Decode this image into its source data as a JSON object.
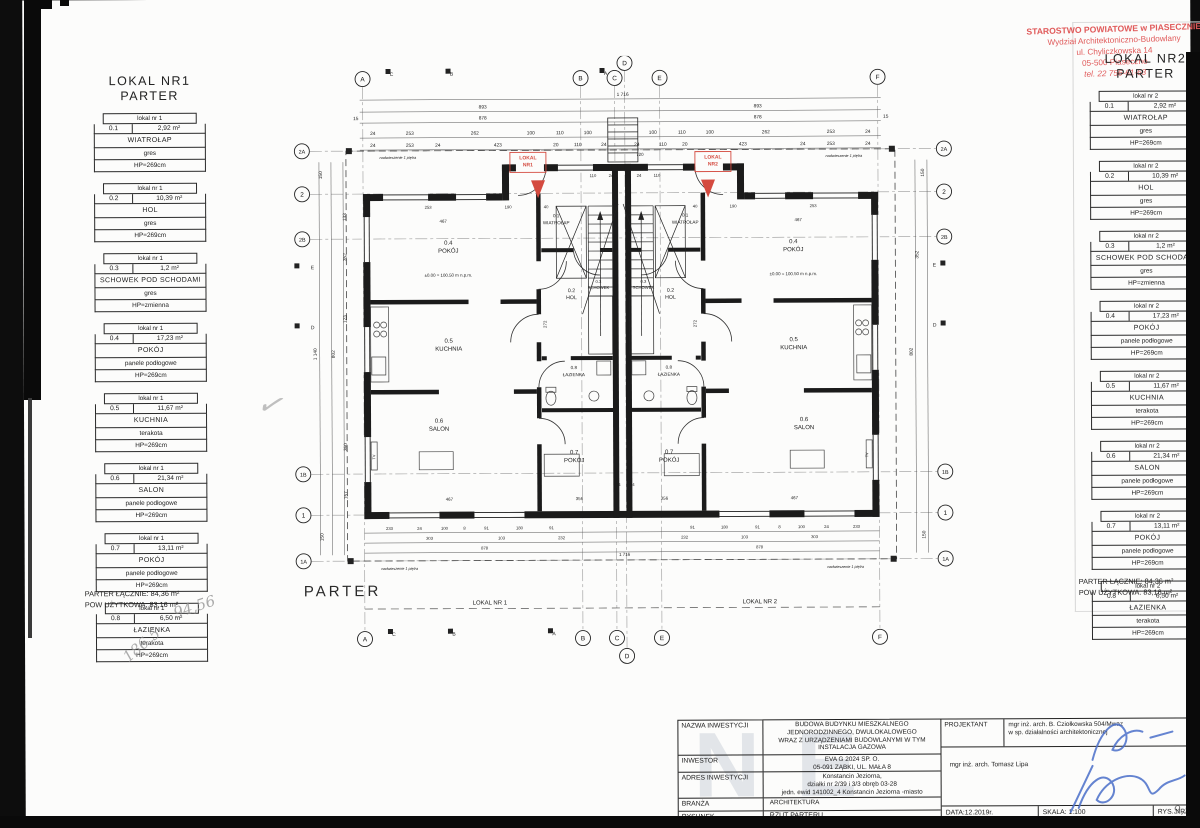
{
  "page": {
    "parter_label": "PARTER"
  },
  "stamp": {
    "line1": "STAROSTWO POWIATOWE w PIASECZNIE",
    "line2": "Wydział Architektoniczno-Budowlany",
    "line3": "ul. Chyliczkowska 14",
    "line4": "05-500 Piaseczno",
    "line5": "tel. 22 756-61-63"
  },
  "legend_left": {
    "title_line1": "LOKAL NR1",
    "title_line2": "PARTER",
    "rooms": [
      {
        "header": "lokal nr 1",
        "id": "0.1",
        "area": "2,92 m²",
        "name": "WIATROŁAP",
        "floor": "gres",
        "height": "HP=269cm"
      },
      {
        "header": "lokal nr 1",
        "id": "0.2",
        "area": "10,39 m²",
        "name": "HOL",
        "floor": "gres",
        "height": "HP=269cm"
      },
      {
        "header": "lokal nr 1",
        "id": "0.3",
        "area": "1,2 m²",
        "name": "SCHOWEK POD SCHODAMI",
        "floor": "gres",
        "height": "HP=zmienna"
      },
      {
        "header": "lokal nr 1",
        "id": "0.4",
        "area": "17,23 m²",
        "name": "POKÓJ",
        "floor": "panele podłogowe",
        "height": "HP=269cm"
      },
      {
        "header": "lokal nr 1",
        "id": "0.5",
        "area": "11,67 m²",
        "name": "KUCHNIA",
        "floor": "terakota",
        "height": "HP=269cm"
      },
      {
        "header": "lokal nr 1",
        "id": "0.6",
        "area": "21,34 m²",
        "name": "SALON",
        "floor": "panele podłogowe",
        "height": "HP=269cm"
      },
      {
        "header": "lokal nr 1",
        "id": "0.7",
        "area": "13,11 m²",
        "name": "POKÓJ",
        "floor": "panele podłogowe",
        "height": "HP=269cm"
      },
      {
        "header": "lokal nr 1",
        "id": "0.8",
        "area": "6,50 m²",
        "name": "ŁAZIENKA",
        "floor": "terakota",
        "height": "HP=269cm"
      }
    ],
    "total1": "PARTER ŁĄCZNIE: 84,36 m²",
    "total2": "POW UŻYTKOWA: 83,16 m²"
  },
  "legend_right": {
    "title_line1": "LOKAL NR2",
    "title_line2": "PARTER",
    "rooms": [
      {
        "header": "lokal nr 2",
        "id": "0.1",
        "area": "2,92 m²",
        "name": "WIATROŁAP",
        "floor": "gres",
        "height": "HP=269cm"
      },
      {
        "header": "lokal nr 2",
        "id": "0.2",
        "area": "10,39 m²",
        "name": "HOL",
        "floor": "gres",
        "height": "HP=269cm"
      },
      {
        "header": "lokal nr 2",
        "id": "0.3",
        "area": "1,2 m²",
        "name": "SCHOWEK POD SCHODAMI",
        "floor": "gres",
        "height": "HP=zmienna"
      },
      {
        "header": "lokal nr 2",
        "id": "0.4",
        "area": "17,23 m²",
        "name": "POKÓJ",
        "floor": "panele podłogowe",
        "height": "HP=269cm"
      },
      {
        "header": "lokal nr 2",
        "id": "0.5",
        "area": "11,67 m²",
        "name": "KUCHNIA",
        "floor": "terakota",
        "height": "HP=269cm"
      },
      {
        "header": "lokal nr 2",
        "id": "0.6",
        "area": "21,34 m²",
        "name": "SALON",
        "floor": "panele podłogowe",
        "height": "HP=269cm"
      },
      {
        "header": "lokal nr 2",
        "id": "0.7",
        "area": "13,11 m²",
        "name": "POKÓJ",
        "floor": "panele podłogowe",
        "height": "HP=269cm"
      },
      {
        "header": "lokal nr 2",
        "id": "0.8",
        "area": "6,50 m²",
        "name": "ŁAZIENKA",
        "floor": "terakota",
        "height": "HP=269cm"
      }
    ],
    "total1": "PARTER ŁĄCZNIE: 84,36 m²",
    "total2": "POW UŻYTKOWA: 83,16 m²"
  },
  "titleblock": {
    "nazwa_label": "NAZWA INWESTYCJI",
    "nazwa": "BUDOWA BUDYNKU MIESZKALNEGO\nJEDNORODZINNEGO, DWULOKALOWEGO\nWRAZ Z URZĄDZENIAMI BUDOWLANYMI W TYM\nINSTALACJA GAZOWA",
    "inwestor_label": "INWESTOR",
    "inwestor": "EVA G 2024 SP. O.\n05-091 ZĄBKI, UL. MAŁA 8",
    "adres_label": "ADRES INWESTYCJI",
    "adres": "Konstancin Jeziorna,\ndziałki nr 2/39 i 3/3 obręb 03-28\njedn. ewid 141002_4 Konstancin Jeziorna -miasto",
    "branza_label": "BRANŻA",
    "branza": "ARCHITEKTURA",
    "rysunek_label": "RYSUNEK",
    "rysunek": "RZUT PARTERU",
    "projektant_label": "PROJEKTANT",
    "projektant": "mgr inż. arch. B. Cziołkowska 504/Mwaz\nw sp. działalności architektonicznej",
    "projektant2": "mgr inż. arch. Tomasz Lipa",
    "data": "DATA:12.2019r.",
    "skala": "SKALA: 1:100",
    "rys_nr": "RYS. NR. A1",
    "signature_color": "#4a6fc9"
  },
  "annotations": {
    "watermark": "NE",
    "pencil1": "94,56",
    "pencil2": "186,5",
    "pencil3": "✓",
    "pencil4": "9,5"
  },
  "plan": {
    "accent_red": "#d44a3f",
    "bubbles": [
      {
        "x": 75,
        "y": 22,
        "t": "A"
      },
      {
        "x": 293,
        "y": 22,
        "t": "B"
      },
      {
        "x": 327,
        "y": 22,
        "t": "C"
      },
      {
        "x": 337,
        "y": 7,
        "t": "D"
      },
      {
        "x": 372,
        "y": 22,
        "t": "E"
      },
      {
        "x": 590,
        "y": 22,
        "t": "F"
      },
      {
        "x": 75,
        "y": 582,
        "t": "A"
      },
      {
        "x": 293,
        "y": 582,
        "t": "B"
      },
      {
        "x": 327,
        "y": 582,
        "t": "C"
      },
      {
        "x": 337,
        "y": 600,
        "t": "D"
      },
      {
        "x": 372,
        "y": 582,
        "t": "E"
      },
      {
        "x": 590,
        "y": 582,
        "t": "F"
      },
      {
        "x": 14,
        "y": 94,
        "t": "2A"
      },
      {
        "x": 14,
        "y": 137,
        "t": "2"
      },
      {
        "x": 14,
        "y": 182,
        "t": "2B"
      },
      {
        "x": 14,
        "y": 417,
        "t": "1B"
      },
      {
        "x": 14,
        "y": 458,
        "t": "1"
      },
      {
        "x": 14,
        "y": 504,
        "t": "1A"
      },
      {
        "x": 656,
        "y": 94,
        "t": "2A"
      },
      {
        "x": 656,
        "y": 137,
        "t": "2"
      },
      {
        "x": 656,
        "y": 182,
        "t": "2B"
      },
      {
        "x": 656,
        "y": 417,
        "t": "1B"
      },
      {
        "x": 656,
        "y": 458,
        "t": "1"
      },
      {
        "x": 656,
        "y": 504,
        "t": "1A"
      }
    ],
    "flags": [
      {
        "x": 98,
        "y": 12
      },
      {
        "x": 158,
        "y": 12
      },
      {
        "x": 312,
        "y": 12
      },
      {
        "x": 98,
        "y": 572
      },
      {
        "x": 158,
        "y": 572
      },
      {
        "x": 258,
        "y": 572
      },
      {
        "x": 6,
        "y": 206
      },
      {
        "x": 6,
        "y": 266
      },
      {
        "x": 652,
        "y": 206
      },
      {
        "x": 652,
        "y": 266
      }
    ],
    "texts": [
      {
        "x": 160,
        "y": 188,
        "t": "0.4",
        "s": 6
      },
      {
        "x": 160,
        "y": 196,
        "t": "POKÓJ",
        "s": 6
      },
      {
        "x": 160,
        "y": 286,
        "t": "0.5",
        "s": 6
      },
      {
        "x": 160,
        "y": 294,
        "t": "KUCHNIA",
        "s": 6
      },
      {
        "x": 150,
        "y": 366,
        "t": "0.6",
        "s": 6
      },
      {
        "x": 150,
        "y": 374,
        "t": "SALON",
        "s": 6
      },
      {
        "x": 268,
        "y": 161,
        "t": "0.1",
        "s": 4.6
      },
      {
        "x": 268,
        "y": 168,
        "t": "WIATROŁAP",
        "s": 4.6
      },
      {
        "x": 283,
        "y": 236,
        "t": "0.2",
        "s": 5.2
      },
      {
        "x": 283,
        "y": 243,
        "t": "HOL",
        "s": 5.2
      },
      {
        "x": 285,
        "y": 313,
        "t": "0.8",
        "s": 4.6
      },
      {
        "x": 285,
        "y": 320,
        "t": "ŁAZIENKA",
        "s": 4.6
      },
      {
        "x": 285,
        "y": 398,
        "t": "0.7",
        "s": 6
      },
      {
        "x": 285,
        "y": 406,
        "t": "POKÓJ",
        "s": 6
      },
      {
        "x": 310,
        "y": 227,
        "t": "0.3",
        "s": 4.2
      },
      {
        "x": 310,
        "y": 233,
        "t": "SCHOWEK",
        "s": 4.2
      },
      {
        "x": 505,
        "y": 188,
        "t": "0.4",
        "s": 6
      },
      {
        "x": 505,
        "y": 196,
        "t": "POKÓJ",
        "s": 6
      },
      {
        "x": 505,
        "y": 286,
        "t": "0.5",
        "s": 6
      },
      {
        "x": 505,
        "y": 294,
        "t": "KUCHNIA",
        "s": 6
      },
      {
        "x": 515,
        "y": 366,
        "t": "0.6",
        "s": 6
      },
      {
        "x": 515,
        "y": 374,
        "t": "SALON",
        "s": 6
      },
      {
        "x": 397,
        "y": 161,
        "t": "0.1",
        "s": 4.6
      },
      {
        "x": 397,
        "y": 168,
        "t": "WIATROŁAP",
        "s": 4.6
      },
      {
        "x": 382,
        "y": 236,
        "t": "0.2",
        "s": 5.2
      },
      {
        "x": 382,
        "y": 243,
        "t": "HOL",
        "s": 5.2
      },
      {
        "x": 380,
        "y": 313,
        "t": "0.8",
        "s": 4.6
      },
      {
        "x": 380,
        "y": 320,
        "t": "ŁAZIENKA",
        "s": 4.6
      },
      {
        "x": 380,
        "y": 398,
        "t": "0.7",
        "s": 6
      },
      {
        "x": 380,
        "y": 406,
        "t": "POKÓJ",
        "s": 6
      },
      {
        "x": 355,
        "y": 227,
        "t": "0.3",
        "s": 4.2
      },
      {
        "x": 355,
        "y": 233,
        "t": "SCHOWEK",
        "s": 4.2
      },
      {
        "x": 160,
        "y": 220,
        "t": "±0.00 = 100.50 m n.p.m.",
        "s": 4.4
      },
      {
        "x": 505,
        "y": 220,
        "t": "±0.00 = 100.50 m n.p.m.",
        "s": 4.4
      },
      {
        "x": 240,
        "y": 103,
        "t": "LOKAL",
        "s": 5,
        "c": "#d44a3f",
        "w": 700
      },
      {
        "x": 240,
        "y": 110,
        "t": "NR1",
        "s": 5,
        "c": "#d44a3f",
        "w": 700
      },
      {
        "x": 425,
        "y": 103,
        "t": "LOKAL",
        "s": 5,
        "c": "#d44a3f",
        "w": 700
      },
      {
        "x": 425,
        "y": 110,
        "t": "NR2",
        "s": 5,
        "c": "#d44a3f",
        "w": 700
      },
      {
        "x": 335,
        "y": 40,
        "t": "1 716"
      },
      {
        "x": 195,
        "y": 52,
        "t": "893"
      },
      {
        "x": 470,
        "y": 52,
        "t": "893"
      },
      {
        "x": 68,
        "y": 63,
        "t": "15"
      },
      {
        "x": 195,
        "y": 63,
        "t": "878"
      },
      {
        "x": 470,
        "y": 63,
        "t": "878"
      },
      {
        "x": 598,
        "y": 63,
        "t": "15"
      },
      {
        "x": 85,
        "y": 78,
        "t": "24"
      },
      {
        "x": 122,
        "y": 78,
        "t": "253"
      },
      {
        "x": 187,
        "y": 78,
        "t": "262"
      },
      {
        "x": 243,
        "y": 78,
        "t": "100"
      },
      {
        "x": 272,
        "y": 78,
        "t": "110"
      },
      {
        "x": 300,
        "y": 78,
        "t": "100"
      },
      {
        "x": 365,
        "y": 78,
        "t": "100"
      },
      {
        "x": 394,
        "y": 78,
        "t": "110"
      },
      {
        "x": 422,
        "y": 78,
        "t": "100"
      },
      {
        "x": 478,
        "y": 78,
        "t": "262"
      },
      {
        "x": 543,
        "y": 78,
        "t": "253"
      },
      {
        "x": 580,
        "y": 78,
        "t": "24"
      },
      {
        "x": 85,
        "y": 90,
        "t": "24"
      },
      {
        "x": 122,
        "y": 90,
        "t": "253"
      },
      {
        "x": 150,
        "y": 90,
        "t": "24"
      },
      {
        "x": 210,
        "y": 90,
        "t": "423"
      },
      {
        "x": 268,
        "y": 90,
        "t": "20"
      },
      {
        "x": 290,
        "y": 90,
        "t": "110"
      },
      {
        "x": 316,
        "y": 90,
        "t": "24"
      },
      {
        "x": 349,
        "y": 90,
        "t": "24"
      },
      {
        "x": 375,
        "y": 90,
        "t": "110"
      },
      {
        "x": 397,
        "y": 90,
        "t": "20"
      },
      {
        "x": 455,
        "y": 90,
        "t": "423"
      },
      {
        "x": 515,
        "y": 90,
        "t": "24"
      },
      {
        "x": 543,
        "y": 90,
        "t": "253"
      },
      {
        "x": 580,
        "y": 90,
        "t": "24"
      },
      {
        "x": 352,
        "y": 100,
        "t": "720",
        "s": 4.4
      },
      {
        "x": 110,
        "y": 102,
        "t": "nadwieszenie 1 piętra",
        "s": 3.8,
        "i": 1
      },
      {
        "x": 556,
        "y": 102,
        "t": "nadwieszenie 1 piętra",
        "s": 3.8,
        "i": 1
      },
      {
        "x": 110,
        "y": 513,
        "t": "nadwieszenie 1 piętra",
        "s": 3.8,
        "i": 1
      },
      {
        "x": 556,
        "y": 513,
        "t": "nadwieszenie 1 piętra",
        "s": 3.8,
        "i": 1
      },
      {
        "x": 305,
        "y": 121,
        "t": "110",
        "s": 4.2
      },
      {
        "x": 323,
        "y": 121,
        "t": "24",
        "s": 4.2
      },
      {
        "x": 351,
        "y": 121,
        "t": "24",
        "s": 4.2
      },
      {
        "x": 369,
        "y": 121,
        "t": "110",
        "s": 4.2
      },
      {
        "x": 140,
        "y": 152,
        "t": "253",
        "s": 4.2
      },
      {
        "x": 220,
        "y": 152,
        "t": "190",
        "s": 4.2
      },
      {
        "x": 258,
        "y": 152,
        "t": "40",
        "s": 4.2
      },
      {
        "x": 407,
        "y": 152,
        "t": "40",
        "s": 4.2
      },
      {
        "x": 445,
        "y": 152,
        "t": "190",
        "s": 4.2
      },
      {
        "x": 525,
        "y": 152,
        "t": "253",
        "s": 4.2
      },
      {
        "x": 155,
        "y": 166,
        "t": "467",
        "s": 4.4
      },
      {
        "x": 510,
        "y": 166,
        "t": "467",
        "s": 4.4
      },
      {
        "x": 258,
        "y": 268,
        "t": "272",
        "s": 4.4,
        "r": -90
      },
      {
        "x": 408,
        "y": 268,
        "t": "272",
        "s": 4.4,
        "r": -90
      },
      {
        "x": 160,
        "y": 444,
        "t": "467",
        "s": 4.4
      },
      {
        "x": 290,
        "y": 444,
        "t": "356",
        "s": 4.4
      },
      {
        "x": 375,
        "y": 444,
        "t": "356",
        "s": 4.4
      },
      {
        "x": 505,
        "y": 444,
        "t": "467",
        "s": 4.4
      },
      {
        "x": 329,
        "y": 430,
        "t": "24",
        "s": 4
      },
      {
        "x": 343,
        "y": 430,
        "t": "24",
        "s": 4
      },
      {
        "x": 100,
        "y": 473,
        "t": "233",
        "s": 4.2
      },
      {
        "x": 130,
        "y": 473,
        "t": "24",
        "s": 4.2
      },
      {
        "x": 155,
        "y": 473,
        "t": "100",
        "s": 4.2
      },
      {
        "x": 175,
        "y": 473,
        "t": "8",
        "s": 4.2
      },
      {
        "x": 197,
        "y": 473,
        "t": "91",
        "s": 4.2
      },
      {
        "x": 230,
        "y": 473,
        "t": "180",
        "s": 4.2
      },
      {
        "x": 262,
        "y": 473,
        "t": "91",
        "s": 4.2
      },
      {
        "x": 403,
        "y": 473,
        "t": "91",
        "s": 4.2
      },
      {
        "x": 435,
        "y": 473,
        "t": "180",
        "s": 4.2
      },
      {
        "x": 468,
        "y": 473,
        "t": "91",
        "s": 4.2
      },
      {
        "x": 490,
        "y": 473,
        "t": "8",
        "s": 4.2
      },
      {
        "x": 512,
        "y": 473,
        "t": "100",
        "s": 4.2
      },
      {
        "x": 537,
        "y": 473,
        "t": "24",
        "s": 4.2
      },
      {
        "x": 567,
        "y": 473,
        "t": "233",
        "s": 4.2
      },
      {
        "x": 140,
        "y": 483,
        "t": "303",
        "s": 4.2
      },
      {
        "x": 212,
        "y": 483,
        "t": "103",
        "s": 4.2
      },
      {
        "x": 272,
        "y": 483,
        "t": "232",
        "s": 4.2
      },
      {
        "x": 395,
        "y": 483,
        "t": "232",
        "s": 4.2
      },
      {
        "x": 455,
        "y": 483,
        "t": "103",
        "s": 4.2
      },
      {
        "x": 525,
        "y": 483,
        "t": "303",
        "s": 4.2
      },
      {
        "x": 195,
        "y": 493,
        "t": "878",
        "s": 4.2
      },
      {
        "x": 470,
        "y": 493,
        "t": "878",
        "s": 4.2
      },
      {
        "x": 335,
        "y": 500,
        "t": "1 716",
        "s": 4.4
      },
      {
        "x": 34,
        "y": 118,
        "t": "150",
        "r": -90
      },
      {
        "x": 34,
        "y": 480,
        "t": "150",
        "r": -90
      },
      {
        "x": 46,
        "y": 297,
        "t": "802",
        "r": -90
      },
      {
        "x": 28,
        "y": 297,
        "t": "1 140",
        "r": -90
      },
      {
        "x": 58,
        "y": 160,
        "t": "133",
        "r": -90
      },
      {
        "x": 58,
        "y": 200,
        "t": "352",
        "r": -90
      },
      {
        "x": 58,
        "y": 262,
        "t": "123",
        "r": -90
      },
      {
        "x": 58,
        "y": 390,
        "t": "360",
        "r": -90
      },
      {
        "x": 58,
        "y": 438,
        "t": "157",
        "r": -90
      },
      {
        "x": 636,
        "y": 118,
        "t": "150",
        "r": -90
      },
      {
        "x": 636,
        "y": 480,
        "t": "150",
        "r": -90
      },
      {
        "x": 624,
        "y": 297,
        "t": "802",
        "r": -90
      },
      {
        "x": 630,
        "y": 200,
        "t": "352",
        "r": -90
      },
      {
        "x": 200,
        "y": 548,
        "t": "LOKAL NR 1",
        "s": 6
      },
      {
        "x": 470,
        "y": 548,
        "t": "LOKAL NR 2",
        "s": 6
      },
      {
        "x": 104,
        "y": 19,
        "t": "C",
        "s": 5
      },
      {
        "x": 164,
        "y": 19,
        "t": "B",
        "s": 5
      },
      {
        "x": 318,
        "y": 19,
        "t": "A",
        "s": 5
      },
      {
        "x": 104,
        "y": 579,
        "t": "C",
        "s": 5
      },
      {
        "x": 164,
        "y": 579,
        "t": "B",
        "s": 5
      },
      {
        "x": 264,
        "y": 579,
        "t": "A",
        "s": 5
      },
      {
        "x": 24,
        "y": 212,
        "t": "E",
        "s": 5
      },
      {
        "x": 24,
        "y": 272,
        "t": "D",
        "s": 5
      },
      {
        "x": 646,
        "y": 212,
        "t": "E",
        "s": 5
      },
      {
        "x": 646,
        "y": 272,
        "t": "D",
        "s": 5
      },
      {
        "x": 86,
        "y": 400,
        "t": "TV",
        "s": 3.8,
        "r": -90
      },
      {
        "x": 579,
        "y": 400,
        "t": "TV",
        "s": 3.8,
        "r": -90
      }
    ]
  }
}
